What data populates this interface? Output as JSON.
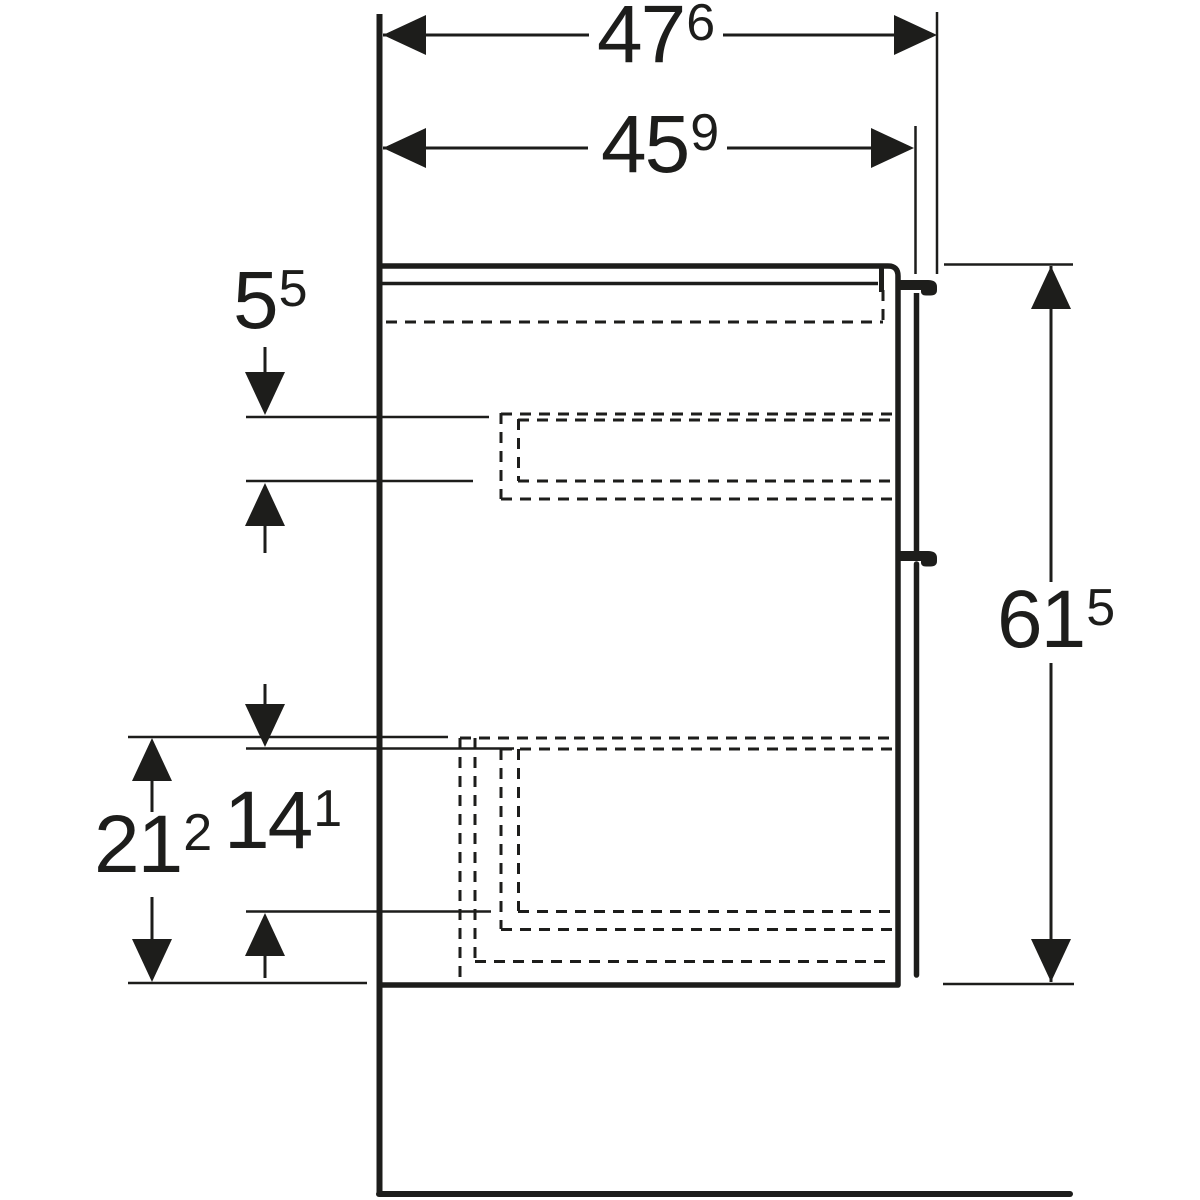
{
  "drawing": {
    "type": "technical-dimension-drawing",
    "view": "side-view",
    "subject": "wall-mounted bathroom vanity cabinet with two drawers",
    "background_color": "#ffffff",
    "line_color": "#1d1d1b",
    "unit_style": "cm with mm superscript",
    "dimensions": {
      "overall_depth": {
        "main": "47",
        "sup": "6"
      },
      "body_depth": {
        "main": "45",
        "sup": "9"
      },
      "top_drawer_clearance": {
        "main": "5",
        "sup": "5"
      },
      "overall_height": {
        "main": "61",
        "sup": "5"
      },
      "lower_section_height": {
        "main": "21",
        "sup": "2"
      },
      "bottom_drawer_clearance": {
        "main": "14",
        "sup": "1"
      }
    }
  }
}
